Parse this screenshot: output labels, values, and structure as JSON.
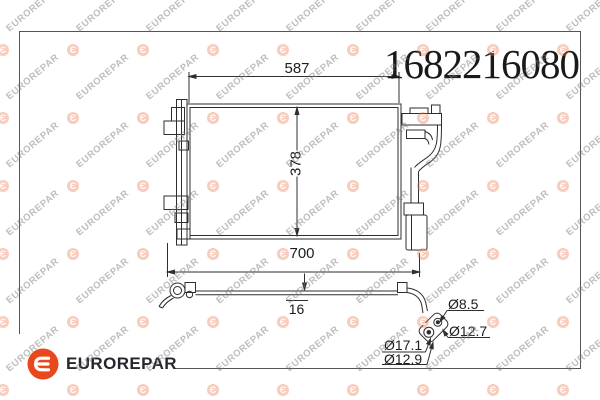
{
  "part_number": "1682216080",
  "brand": {
    "name": "EUROREPAR"
  },
  "watermark": {
    "text": "EUROREPAR",
    "emblem_glyph": "Є"
  },
  "colors": {
    "brand_orange": "#e8481c",
    "line": "#2e2e2e",
    "frame": "#555555",
    "text": "#1d1d1d"
  },
  "diagram": {
    "dimensions": {
      "width_top": "587",
      "height": "378",
      "width_overall": "700",
      "pipe_offset": "16",
      "dia_small": "Ø8.5",
      "dia_medium": "Ø12.7",
      "dia_large": "Ø17.1",
      "dia_inner": "Ø12.9"
    }
  }
}
